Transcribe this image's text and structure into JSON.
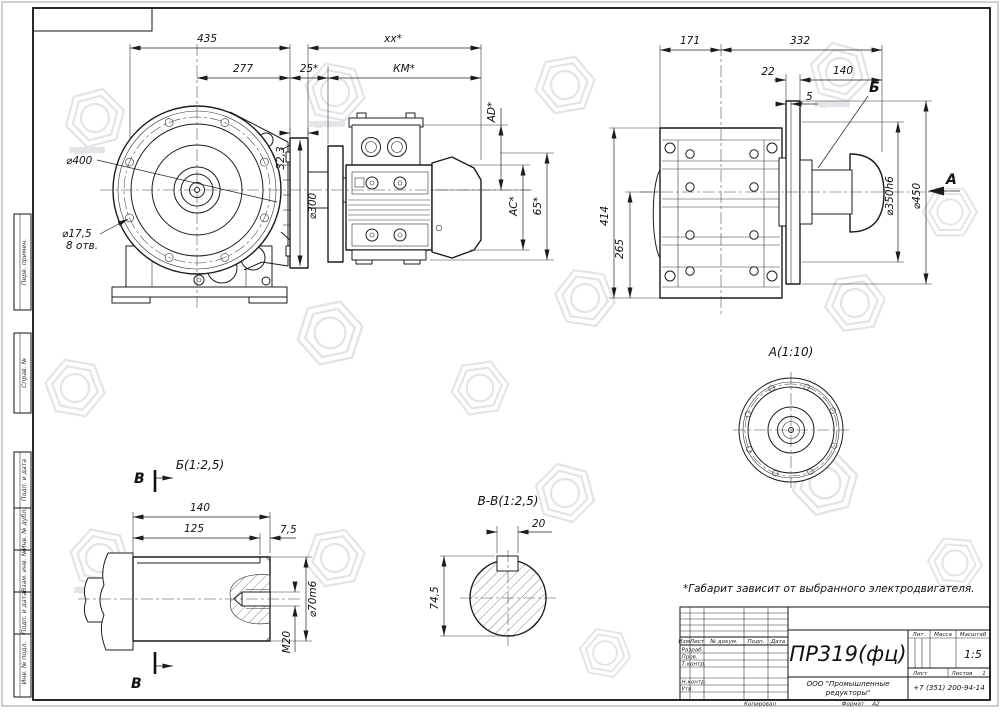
{
  "watermark": {
    "text": "РЕДУКТОРЫ"
  },
  "note": "*Габарит зависит от выбранного электродвигателя.",
  "frame": {
    "stubs": [
      "Перв. примен.",
      "Справ. №",
      "Подп. и дата",
      "Инв. № дубл.",
      "Взам. инв. №",
      "Подп. и дата",
      "Инв. № подл."
    ]
  },
  "front_view": {
    "dia400": "⌀400",
    "dia17_5": "⌀17,5",
    "holes8": "8 отв.",
    "dim435": "435",
    "dimxx": "xx*",
    "dim277": "277",
    "dim25": "25*",
    "dimkm": "КМ*",
    "dim323": "32,3",
    "dia300": "⌀300",
    "dim_ad": "AD*",
    "dim_ac": "AC*",
    "dim_65": "65*"
  },
  "side_view": {
    "dim171": "171",
    "dim332": "332",
    "dim22": "22",
    "dim140": "140",
    "dim5": "5",
    "label_b": "Б",
    "dia350": "⌀350h6",
    "dia450": "⌀450",
    "dim414": "414",
    "dim265": "265",
    "label_a": "А"
  },
  "view_a": {
    "label": "А(1:10)"
  },
  "view_b": {
    "label": "Б(1:2,5)",
    "marker": "В",
    "dim140": "140",
    "dim125": "125",
    "dim7_5": "7,5",
    "dia70": "⌀70m6",
    "m20": "М20"
  },
  "section_vv": {
    "label": "В-В(1:2,5)",
    "dim20": "20",
    "dim74_5": "74,5"
  },
  "title_block": {
    "title": "ПР319(фц)",
    "company_line1": "ООО \"Промышленные",
    "company_line2": "редукторы\"",
    "phone": "+7 (351) 200-94-14",
    "scale_value": "1:5",
    "sheets_value": "1",
    "col_izm": "Изм.",
    "col_list": "Лист",
    "col_doc": "№ докум.",
    "col_podp": "Подп.",
    "col_data": "Дата",
    "row_razrab": "Разраб.",
    "row_prov": "Пров.",
    "row_tkontr": "Т.контр.",
    "row_nkontr": "Н.контр.",
    "row_utv": "Утв.",
    "lit": "Лит.",
    "massa": "Масса",
    "masshtab": "Масштаб",
    "list": "Лист",
    "listov": "Листов",
    "kopiroval": "Копировал",
    "format_label": "Формат",
    "format_value": "А2"
  }
}
